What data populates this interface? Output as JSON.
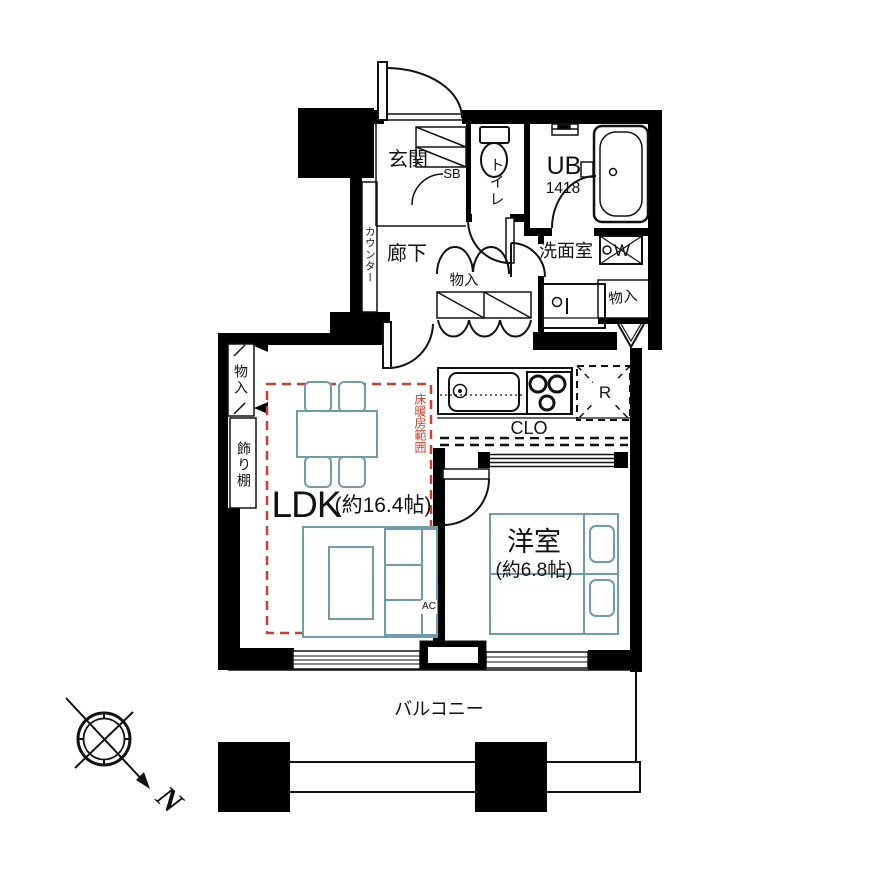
{
  "plan": {
    "title": "1LDK floor plan",
    "compass": {
      "north": "N"
    },
    "colors": {
      "wall": "#000000",
      "furniture_outline": "#6f9bad",
      "floor_heating_line": "#c9402e"
    },
    "labels": {
      "entrance": "玄関",
      "shoe_box": "SB",
      "toilet": "トイレ",
      "unit_bath": "UB",
      "unit_bath_size": "1418",
      "washroom": "洗面室",
      "washing_machine": "W",
      "hallway": "廊下",
      "counter": "カウンター",
      "storage_hallway": "物入",
      "storage_right": "物入",
      "storage_ldk": "物入",
      "display_shelf": "飾り棚",
      "floor_heating_area": "床暖房範囲",
      "closet": "CLO",
      "refrigerator": "R",
      "ldk": "LDK",
      "ldk_size": "(約16.4帖)",
      "bedroom": "洋室",
      "bedroom_size": "(約6.8帖)",
      "air_conditioner": "AC",
      "balcony": "バルコニー"
    }
  }
}
